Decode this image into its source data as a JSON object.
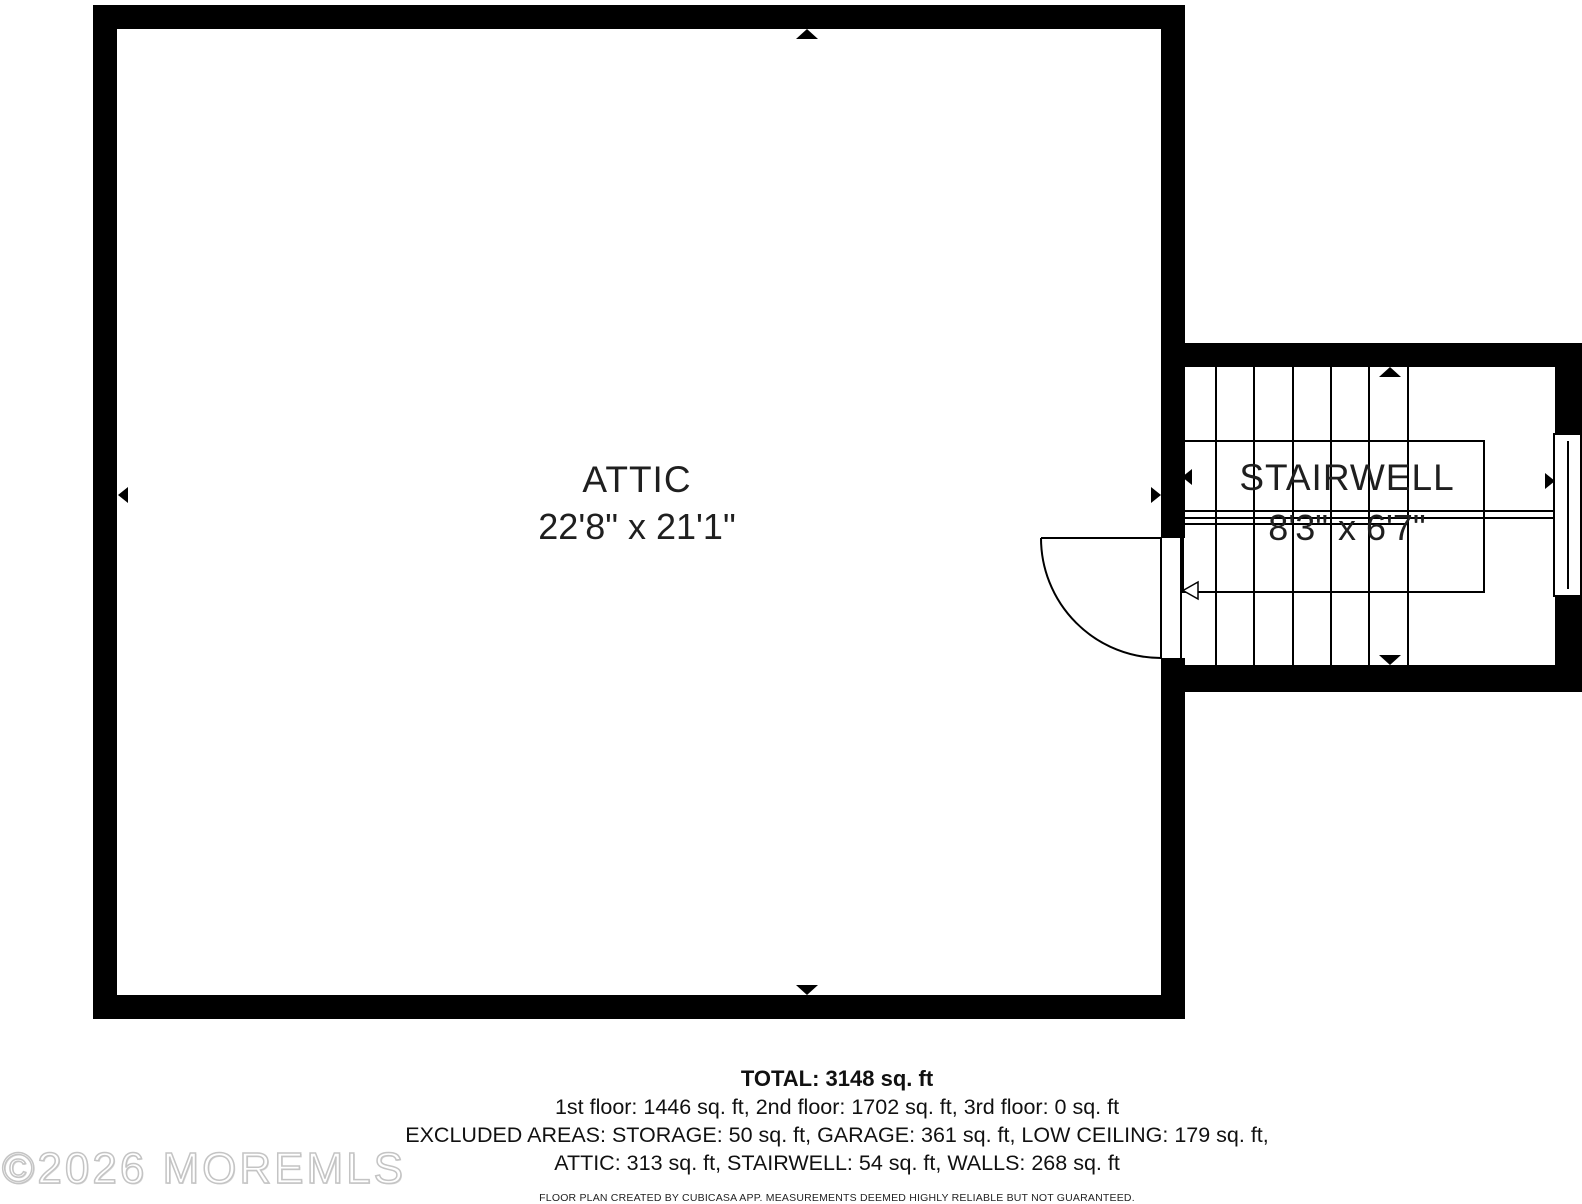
{
  "floor_plan": {
    "rooms": [
      {
        "name": "ATTIC",
        "dimensions": "22'8\" x 21'1\""
      },
      {
        "name": "STAIRWELL",
        "dimensions": "8'3\" x 6'7\""
      }
    ],
    "summary": {
      "total": "TOTAL: 3148 sq. ft",
      "floors": "1st floor: 1446 sq. ft, 2nd floor: 1702 sq. ft, 3rd floor: 0 sq. ft",
      "excluded_line1": "EXCLUDED AREAS: STORAGE: 50 sq. ft, GARAGE: 361 sq. ft, LOW CEILING: 179 sq. ft,",
      "excluded_line2": "ATTIC: 313 sq. ft, STAIRWELL: 54 sq. ft, WALLS: 268 sq. ft"
    },
    "disclaimer": "FLOOR PLAN CREATED BY CUBICASA APP. MEASUREMENTS DEEMED HIGHLY RELIABLE BUT NOT GUARANTEED.",
    "watermark": "©2026 MOREMLS",
    "colors": {
      "wall": "#000000",
      "text": "#1f1f1f",
      "watermark_outline": "#c4c4c4"
    }
  }
}
